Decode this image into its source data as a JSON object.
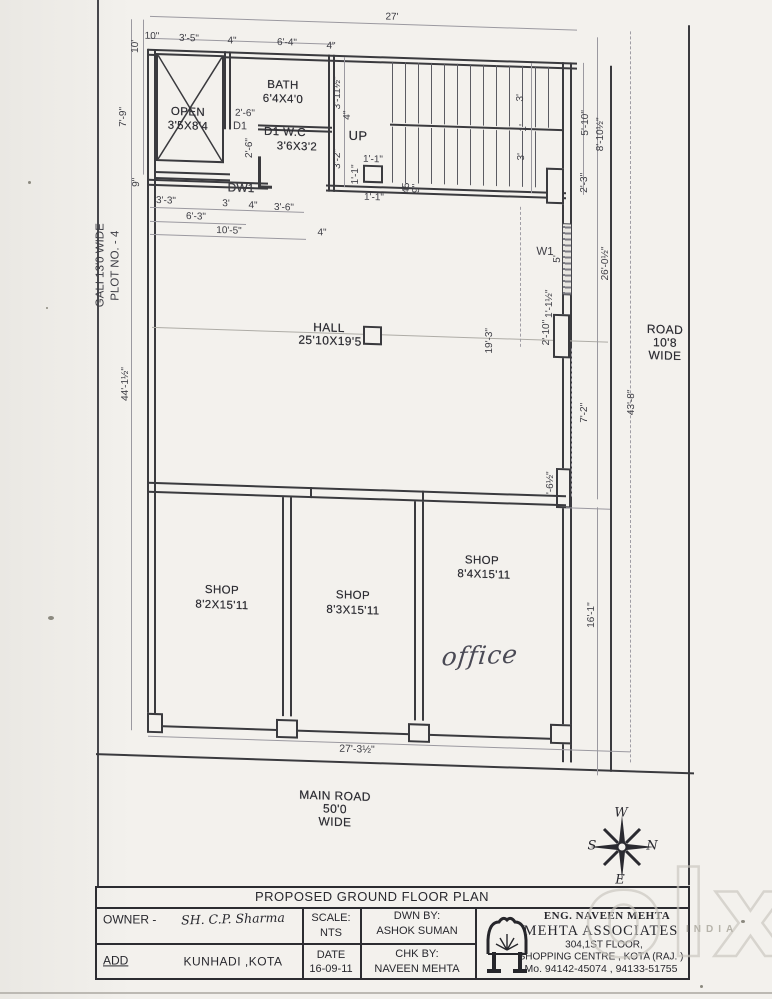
{
  "plan": {
    "rooms": {
      "open": {
        "name": "OPEN",
        "size": "3'5X8'4"
      },
      "bath": {
        "name": "BATH",
        "size": "6'4X4'0"
      },
      "wc": {
        "name": "D1 W.C",
        "size": "3'6X3'2"
      },
      "hall": {
        "name": "HALL",
        "size": "25'10X19'5"
      },
      "shop1": {
        "name": "SHOP",
        "size": "8'2X15'11"
      },
      "shop2": {
        "name": "SHOP",
        "size": "8'3X15'11"
      },
      "shop3": {
        "name": "SHOP",
        "size": "8'4X15'11",
        "note": "office"
      },
      "stair": {
        "label": "UP"
      }
    },
    "doors": {
      "d1": "D1",
      "dw1": "DW1",
      "w1": "W1"
    },
    "dims": {
      "top_27": "27'",
      "top_10in": "10\"",
      "top_3_5": "3'-5\"",
      "top_4a": "4\"",
      "top_6_4": "6'-4\"",
      "top_4b": "4\"",
      "left_10": "10'",
      "left_7_9": "7'-9\"",
      "left_9": "9\"",
      "left_44": "44'-1½\"",
      "bath_2_6": "2'-6\"",
      "wc_2_6": "2'-6\"",
      "st_3_11": "3'-11½\"",
      "st_4": "4\"",
      "st_3_2": "3'-2\"",
      "col_1_1a": "1'-1\"",
      "col_1_1b": "1'-1\"",
      "col_1_1c": "1'-1\"",
      "st_45": "45",
      "st_9": "9\"",
      "fl_3a": "3'",
      "fl_1": "1'",
      "fl_3b": "3'",
      "b_3_3": "3'-3\"",
      "b_3": "3'",
      "b_4": "4\"",
      "b_3_6": "3'-6\"",
      "b_6_3": "6'-3\"",
      "b_10_5": "10'-5\"",
      "b_4b": "4\"",
      "r_2_3": "2'-3\"",
      "r_5_10": "5'-10\"",
      "r_8_10": "8'-10½\"",
      "r_5": "5'",
      "r_1_1h": "1'-1½\"",
      "r_2_10": "2'-10\"",
      "r_26": "26'-0½\"",
      "r_19_3": "19'-3\"",
      "r_7_2": "7'-2\"",
      "r_43_8": "43'-8\"",
      "r_6h": "'-6½\"",
      "r_16_1": "16'-1\"",
      "bot_27_3": "27'-3½\""
    },
    "roads": {
      "gali": {
        "l1": "GALI 13'0 WIDE",
        "l2": "PLOT NO. - 4"
      },
      "right": {
        "l1": "ROAD",
        "l2": "10'8",
        "l3": "WIDE"
      },
      "main": {
        "l1": "MAIN ROAD",
        "l2": "50'0",
        "l3": "WIDE"
      }
    }
  },
  "compass": {
    "w": "W",
    "n": "N",
    "e": "E",
    "s": "S"
  },
  "watermark": {
    "logo": "olx",
    "country": "INDIA"
  },
  "title_block": {
    "title": "PROPOSED GROUND FLOOR PLAN",
    "owner_label": "OWNER -",
    "owner_value": "SH. C.P. Sharma",
    "add_label": "ADD",
    "add_value": "KUNHADI ,KOTA",
    "scale_label": "SCALE:",
    "scale_value": "NTS",
    "date_label": "DATE",
    "date_value": "16-09-11",
    "dwn_label": "DWN BY:",
    "dwn_value": "ASHOK SUMAN",
    "chk_label": "CHK BY:",
    "chk_value": "NAVEEN MEHTA",
    "firm": {
      "eng": "ENG. NAVEEN MEHTA",
      "name": "MEHTA ASSOCIATES",
      "addr1": "304,1ST FLOOR,",
      "addr2": "SHOPPING CENTRE , KOTA (RAJ. )",
      "phone": "Mo. 94142-45074 , 94133-51755"
    }
  }
}
